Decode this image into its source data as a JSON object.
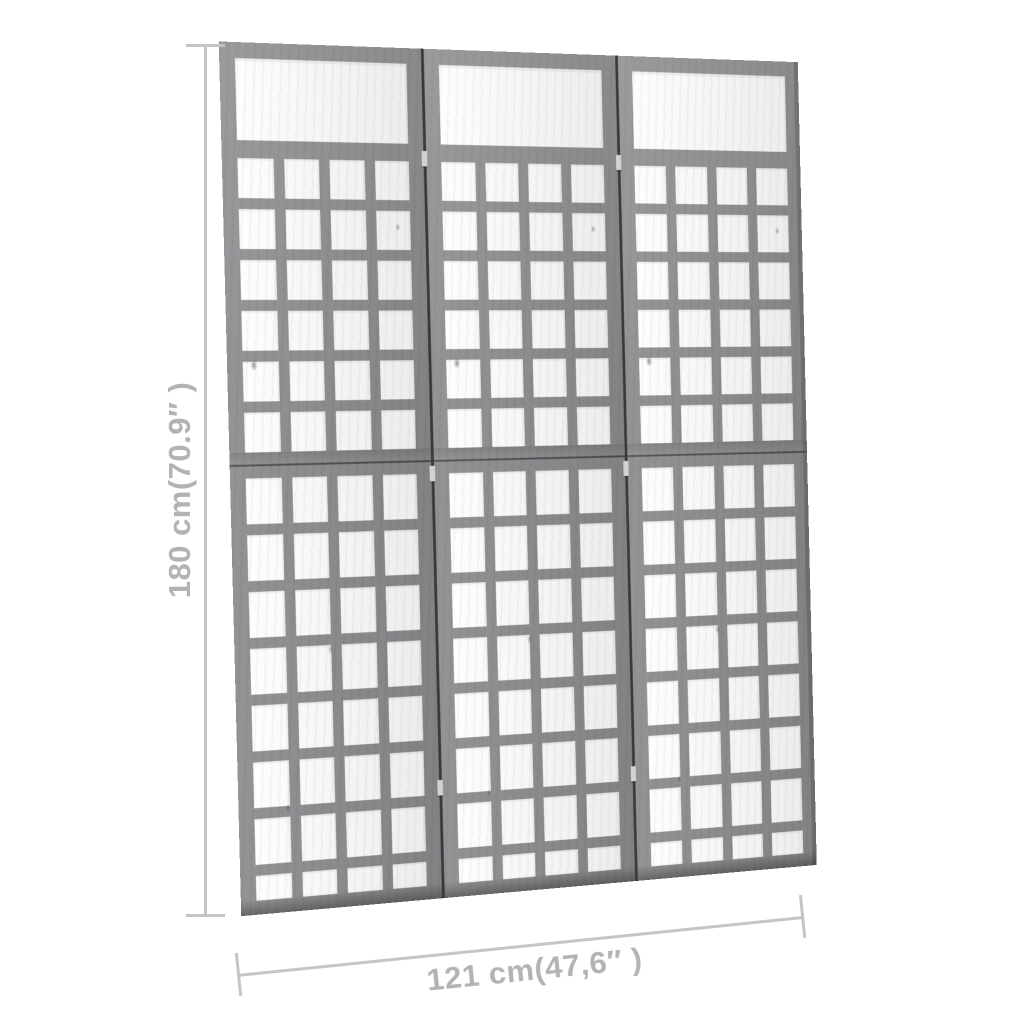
{
  "product": {
    "type": "3-panel wooden trellis room divider, gray"
  },
  "dimensions": {
    "height_label": "180 cm(70.9″ )",
    "width_label": "121 cm(47,6″ )"
  },
  "trellis": {
    "panel_count": 3,
    "columns_per_panel": 4,
    "upper_rows": 6,
    "lower_rows": 8,
    "has_top_window": true,
    "hinge_positions_pct": [
      12,
      49,
      86
    ]
  },
  "colors": {
    "wood": "#8e8c8f",
    "wood_light": "#979598",
    "panel_seam": "#3a383b",
    "mid_seam": "#504e51",
    "hinge": "#d3d1d2",
    "dimension_line": "#c6c4c5",
    "dimension_text": "#b4b2b3",
    "background": "#ffffff"
  }
}
